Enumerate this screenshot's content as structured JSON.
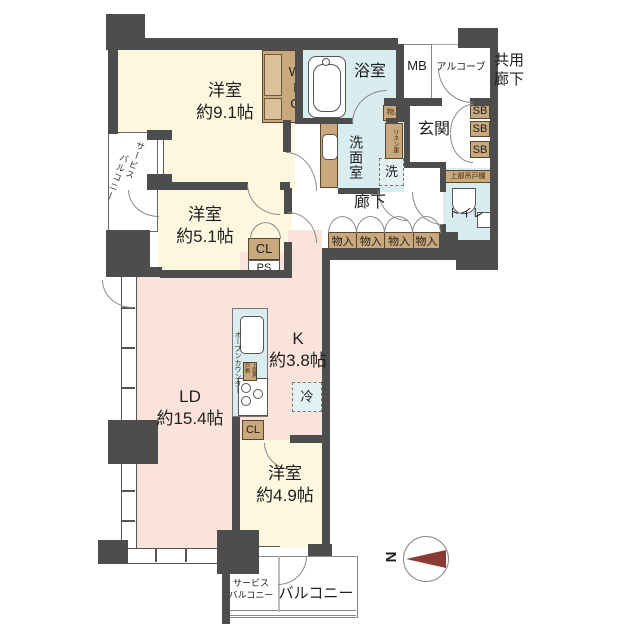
{
  "rooms": {
    "bedroom1": {
      "name": "洋室",
      "size": "約9.1帖"
    },
    "bedroom2": {
      "name": "洋室",
      "size": "約5.1帖"
    },
    "living": {
      "name": "LD",
      "size": "約15.4帖"
    },
    "kitchen": {
      "name": "K",
      "size": "約3.8帖"
    },
    "bedroom3": {
      "name": "洋室",
      "size": "約4.9帖"
    }
  },
  "wet_areas": {
    "bath": "浴室",
    "washroom": "洗面室",
    "toilet": "トイレ",
    "washer": "洗",
    "fridge": "冷"
  },
  "entrance": {
    "genkan": "玄関",
    "meter_box": "MB",
    "alcove": "アルコーブ",
    "common_corridor_line1": "共用",
    "common_corridor_line2": "廊下",
    "shoe_box1": "SB",
    "shoe_box2": "SB",
    "shoe_box3": "SB",
    "storage_small": "物入",
    "linen": "リネン庫",
    "upper_shelf": "上部吊戸棚"
  },
  "hallway": {
    "label": "廊下"
  },
  "storage": {
    "wic": "WIC",
    "closet": "CL",
    "pipe_space": "PS",
    "closet2": "CL",
    "row": [
      "物入",
      "物入",
      "物入",
      "物入"
    ]
  },
  "kitchen_detail": {
    "open_counter": "オープンカウンター",
    "upper_shelf": "上部吊戸棚"
  },
  "balconies": {
    "service_side_line1": "サービス",
    "service_side_line2": "バルコニー",
    "service_bottom_line1": "サービス",
    "service_bottom_line2": "バルコニー",
    "main": "バルコニー"
  },
  "compass": {
    "north": "N"
  },
  "colors": {
    "wall": "#4d4d4d",
    "western_room": "#fdf7e0",
    "ldk": "#fae3da",
    "wet_area": "#d9edf0",
    "storage": "#c9a87e",
    "compass_needle": "#8a3c34"
  }
}
